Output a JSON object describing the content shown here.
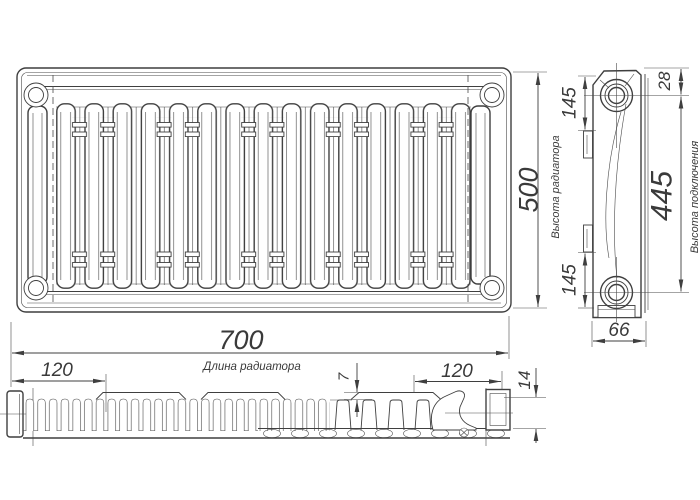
{
  "meta": {
    "drawing_type": "radiator technical drawing",
    "background": "#ffffff",
    "line_color": "#3f3f3f",
    "text_color": "#3a3a3a"
  },
  "dims": {
    "length": {
      "value": "700",
      "label": "Длина радиатора"
    },
    "height": {
      "value": "500",
      "label": "Высота радиатора"
    },
    "connection_height": {
      "value": "445",
      "label": "Высота подключения"
    },
    "depth": {
      "value": "66"
    },
    "mount_top": {
      "value": "145"
    },
    "mount_bottom": {
      "value": "145"
    },
    "top_offset": {
      "value": "28"
    },
    "inset_left": {
      "value": "120"
    },
    "inset_right": {
      "value": "120"
    },
    "lip_thickness": {
      "value": "7"
    },
    "bracket_height": {
      "value": "14"
    }
  }
}
